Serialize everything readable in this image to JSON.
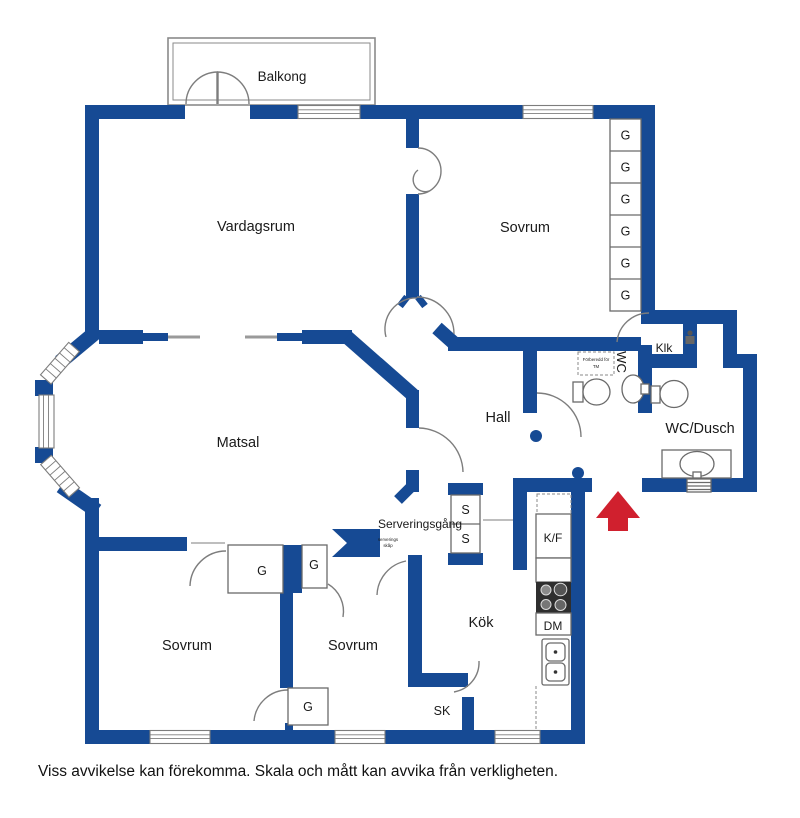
{
  "colors": {
    "wall": "#164a94",
    "door": "#7d7d7d",
    "fixture": "#6a6a6a",
    "arrow": "#d0202e",
    "text": "#1a1a1a",
    "balcony_line": "#8a8a8a"
  },
  "rooms": {
    "balkong": "Balkong",
    "vardagsrum": "Vardagsrum",
    "sovrum_top": "Sovrum",
    "klk": "Klk",
    "wc_vertical": "WC",
    "wc_dusch": "WC/Dusch",
    "hall": "Hall",
    "matsal": "Matsal",
    "serveringsgang": "Serveringsgång",
    "sovrum_left": "Sovrum",
    "sovrum_mid": "Sovrum",
    "kok": "Kök",
    "sk": "SK"
  },
  "closets": {
    "g": "G",
    "s": "S",
    "kf": "K/F",
    "dm": "DM"
  },
  "annotations": {
    "tm_line1": "Förberedd för",
    "tm_line2": "TM",
    "cab_line1": "serverings",
    "cab_line2": "skåp"
  },
  "footer": {
    "disclaimer": "Viss avvikelse kan förekomma. Skala och mått kan avvika från verkligheten."
  }
}
